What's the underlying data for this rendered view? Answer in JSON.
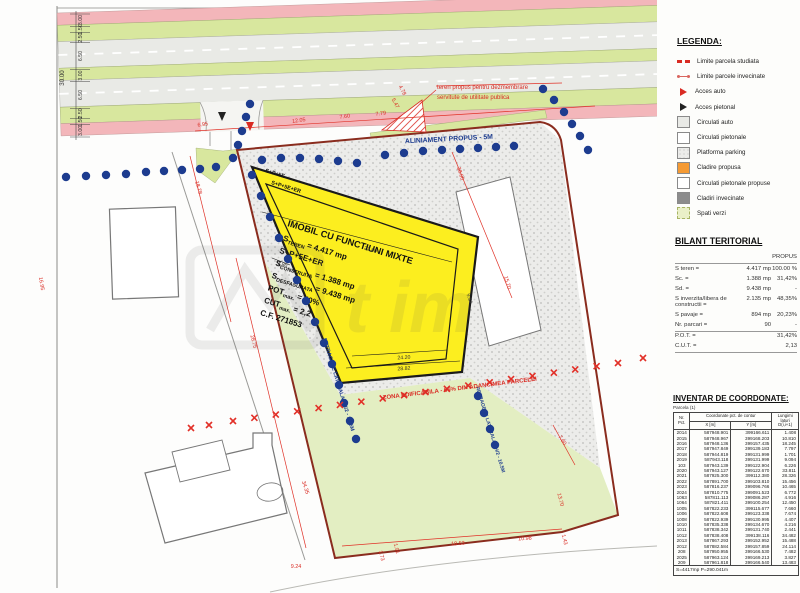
{
  "page": {
    "clipped_header": "Beneficiar: SC Grup Proiect SRL"
  },
  "watermark": {
    "text": "t im"
  },
  "colors": {
    "parcel_yellow": "#fcee1f",
    "setback_blue": "#1d3c8f",
    "boundary_red": "#8a2c1e",
    "annotation_red": "#e03127",
    "green_area": "#e3eec2",
    "road_green": "#d8e79e",
    "road_pink": "#f3b6ba",
    "legend_orange": "#f59a33"
  },
  "legend": {
    "title": "LEGENDA:",
    "items": [
      {
        "label": "Limite parcela studiata",
        "swatch": "dash-red"
      },
      {
        "label": "Limite parcele invecinate",
        "swatch": "line-red"
      },
      {
        "label": "Acces auto",
        "swatch": "triangle-red"
      },
      {
        "label": "Acces pietonal",
        "swatch": "triangle-black"
      },
      {
        "label": "Circulati auto",
        "swatch": "gray"
      },
      {
        "label": "Circulati pietonale",
        "swatch": "white"
      },
      {
        "label": "Platforma parking",
        "swatch": "stipple"
      },
      {
        "label": "Cladire propusa",
        "swatch": "orange"
      },
      {
        "label": "Circulati pietonale propuse",
        "swatch": "white"
      },
      {
        "label": "Cladiri invecinate",
        "swatch": "dark-gray"
      },
      {
        "label": "Spati verzi",
        "swatch": "green"
      }
    ]
  },
  "bilant": {
    "title": "BILANT TERITORIAL",
    "col_header": "PROPUS",
    "rows": [
      [
        "S teren =",
        "4.417 mp",
        "100.00 %"
      ],
      [
        "Sc. =",
        "1.388 mp",
        "31,42%"
      ],
      [
        "Sd. =",
        "9.438 mp",
        "-"
      ],
      [
        "S inverzita/libera de constructii =",
        "2.135 mp",
        "48,35%"
      ],
      [
        "S pavaje =",
        "894 mp",
        "20,23%"
      ],
      [
        "Nr. parcari =",
        "90",
        "-"
      ],
      [
        "P.O.T. =",
        "",
        "31,42%"
      ],
      [
        "C.U.T. =",
        "",
        "2,13"
      ]
    ]
  },
  "coords": {
    "title": "INVENTAR DE COORDONATE:",
    "subtitle": "Parcela (1)",
    "col_nr": "Nr. Pct.",
    "col_group": "Coordonate pct. de contur",
    "col_x": "X [m]",
    "col_y": "Y [m]",
    "col_d": "Lungimi laturi D(i,i+1)",
    "rows": [
      [
        "2014",
        "587948.901",
        "399166.611",
        "1.408"
      ],
      [
        "2015",
        "587948.967",
        "399168.203",
        "10.810"
      ],
      [
        "2016",
        "587948.136",
        "399157.435",
        "18.245"
      ],
      [
        "2017",
        "587947.849",
        "399139.183",
        "7.797"
      ],
      [
        "2018",
        "587944.819",
        "399131.999",
        "1.701"
      ],
      [
        "2019",
        "587943.118",
        "399131.999",
        "9.094"
      ],
      [
        "103",
        "587943.139",
        "399122.904",
        "6.226"
      ],
      [
        "2020",
        "587943.127",
        "399122.670",
        "33.811"
      ],
      [
        "2021",
        "587925.300",
        "399112.380",
        "28.326"
      ],
      [
        "2022",
        "587891.700",
        "399103.810",
        "15.456"
      ],
      [
        "2023",
        "587816.237",
        "399096.766",
        "10.465"
      ],
      [
        "2024",
        "587810.775",
        "399091.523",
        "6.772"
      ],
      [
        "1063",
        "587811.113",
        "399086.287",
        "4.916"
      ],
      [
        "1064",
        "587821.411",
        "399100.254",
        "12.450"
      ],
      [
        "1005",
        "587822.233",
        "399115.677",
        "7.660"
      ],
      [
        "1006",
        "587822.608",
        "399123.338",
        "7.674"
      ],
      [
        "1008",
        "587822.939",
        "399130.995",
        "4.407"
      ],
      [
        "1010",
        "587835.338",
        "399134.670",
        "4.216"
      ],
      [
        "1011",
        "587838.342",
        "399131.740",
        "2.441"
      ],
      [
        "1012",
        "587838.408",
        "399138.116",
        "34.482"
      ],
      [
        "2013",
        "587867.293",
        "399152.952",
        "15.488"
      ],
      [
        "2012",
        "587882.584",
        "399157.859",
        "24.114"
      ],
      [
        "208",
        "587950.955",
        "399166.530",
        "7.482"
      ],
      [
        "2025",
        "587963.124",
        "399169.213",
        "3.827"
      ],
      [
        "209",
        "587961.818",
        "399166.540",
        "13.483"
      ]
    ],
    "footer": "S=4417mp   P=290.041m"
  },
  "building": {
    "title": "IMOBIL CU FUNCTIUNI MIXTE",
    "tag1": "S+P+5E",
    "tag2": "S+P+5E+ER",
    "lines": [
      {
        "pre": "S",
        "sub": "TEREN",
        "rest": " = 4.417 mp"
      },
      {
        "pre": "S+P+5E+ER",
        "sub": "",
        "rest": ""
      },
      {
        "pre": "S",
        "sub": "CONSTRUITA",
        "rest": " = 1.388 mp"
      },
      {
        "pre": "S",
        "sub": "DESFASURATA",
        "rest": " = 9.438 mp"
      },
      {
        "pre": "POT",
        "sub": "max.",
        "rest": " = 40%"
      },
      {
        "pre": "CUT",
        "sub": "max.",
        "rest": " = 2,2"
      },
      {
        "pre": "C.F. 271853",
        "sub": "",
        "rest": ""
      }
    ]
  },
  "plan": {
    "aliniament": "ALINIAMENT PROPUS - 5M",
    "retragere": "RETRAGERE LATERALA - H/2 - 10.5M",
    "zona": "ZONA EDIFICABILA - 65% DIN ADANCIMEA PARCELEI",
    "teren_note_1": "teren propus pentru dezmembrare",
    "teren_note_2": "servitute de utilitate publica",
    "road_dims": [
      "3.00",
      "1.50",
      "2.50",
      "6.50",
      "3.00",
      "6.50",
      "2.50",
      "1.50",
      "3.00"
    ],
    "road_total": "30.00",
    "dims": [
      "6.95",
      "12.05",
      "7.60",
      "7.79",
      "5.47",
      "4.78",
      "18.78",
      "28.75",
      "34.35",
      "38.00",
      "15.70",
      "9.24",
      "1.73",
      "1.91",
      "18.53",
      "10.98",
      "1.43",
      "13.70",
      "7.60",
      "22.80",
      "1.80",
      "9.54",
      "24.20",
      "28.82",
      "16.95"
    ]
  }
}
